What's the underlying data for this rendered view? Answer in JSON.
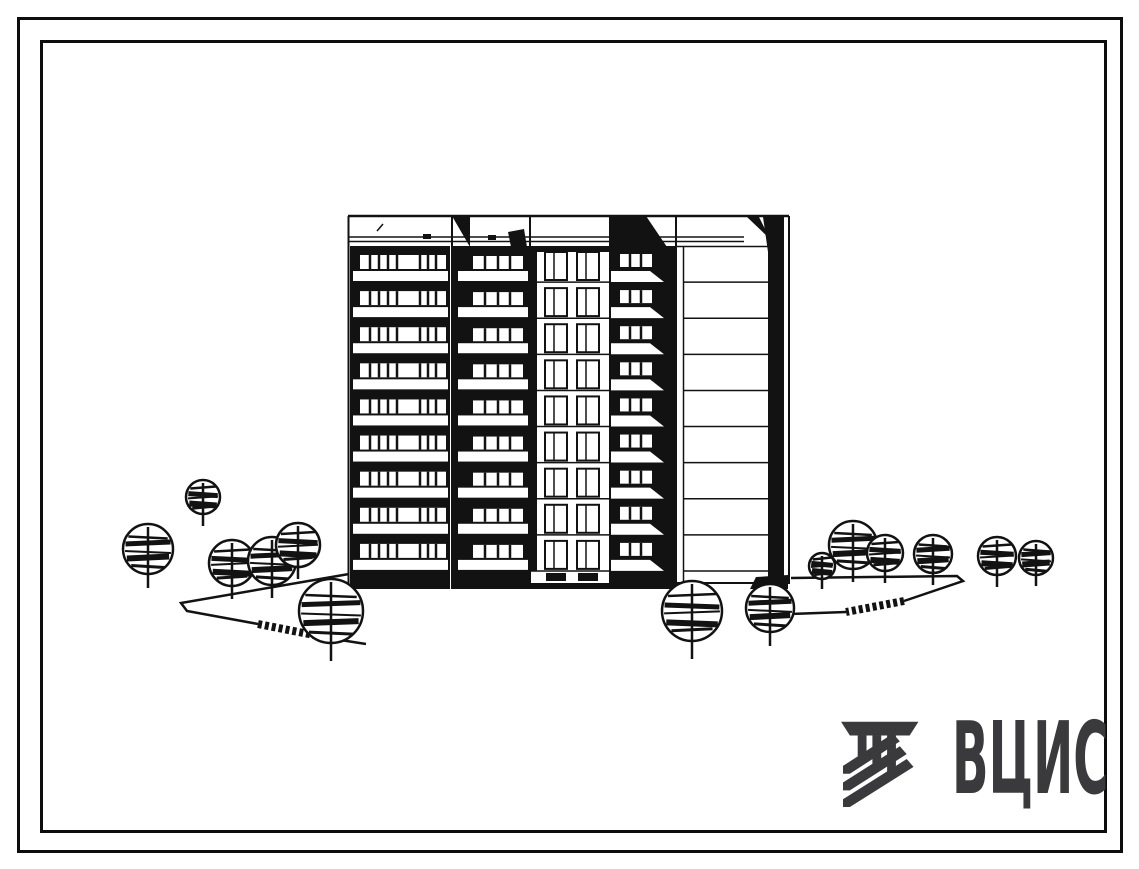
{
  "logo": {
    "text": "ВЦИС",
    "color": "#3a3a3d",
    "emblem": "vcis-column-emblem"
  },
  "drawing": {
    "type": "building-elevation",
    "ink": "#121212",
    "paper": "#ffffff",
    "floors": 9,
    "building": {
      "left": 348,
      "right": 790,
      "top": 215,
      "body_top": 246,
      "body_bottom": 571,
      "base_bottom": 589
    },
    "sections": {
      "A": {
        "name": "balcony-band-wide",
        "win": {
          "x": 360,
          "w": 86,
          "y": 9,
          "h": 14,
          "div": [
            10,
            19,
            28,
            37,
            60,
            68,
            76
          ]
        },
        "slab": {
          "x": 353,
          "w": 95,
          "y": 25,
          "h": 10
        }
      },
      "B": {
        "name": "balcony-band-narrow",
        "win": {
          "x": 473,
          "w": 50,
          "y": 10,
          "h": 13,
          "div": [
            12,
            25,
            37
          ]
        },
        "slab": {
          "x": 458,
          "w": 70,
          "y": 25,
          "h": 10
        }
      },
      "C": {
        "name": "window-bay",
        "x": 530,
        "w": 80,
        "win_xs": [
          545,
          577
        ],
        "win_w": 22,
        "win_h": 28,
        "win_y": 6,
        "mullion": 9
      },
      "D": {
        "name": "balcony-shadow-band",
        "win": {
          "x": 620,
          "w": 32,
          "y": 8,
          "h": 13,
          "div": [
            10,
            21
          ]
        },
        "slab_poly_dy": [
          25,
          36
        ],
        "slab_x": [
          610,
          650,
          664
        ]
      },
      "E": {
        "name": "end-wall",
        "line_x0": 684,
        "line_x1": 768
      }
    },
    "static_lines": [
      {
        "p": [
          [
            348,
            216
          ],
          [
            789,
            216
          ]
        ],
        "w": 2.5
      },
      {
        "p": [
          [
            349,
            237
          ],
          [
            744,
            237
          ]
        ],
        "w": 1.5
      },
      {
        "p": [
          [
            349,
            241.5
          ],
          [
            744,
            241.5
          ]
        ],
        "w": 1.5
      },
      {
        "p": [
          [
            377,
            231
          ],
          [
            383,
            224
          ]
        ],
        "w": 1.5
      },
      {
        "p": [
          [
            348.5,
            216
          ],
          [
            348.5,
            589
          ]
        ],
        "w": 2
      },
      {
        "p": [
          [
            452,
            216
          ],
          [
            452,
            589
          ]
        ],
        "w": 2
      },
      {
        "p": [
          [
            530,
            216
          ],
          [
            530,
            589
          ]
        ],
        "w": 2
      },
      {
        "p": [
          [
            610,
            216
          ],
          [
            610,
            589
          ]
        ],
        "w": 2
      },
      {
        "p": [
          [
            676,
            216
          ],
          [
            676,
            583
          ]
        ],
        "w": 2
      },
      {
        "p": [
          [
            789,
            216
          ],
          [
            789,
            583
          ]
        ],
        "w": 2
      },
      {
        "p": [
          [
            683.5,
            246
          ],
          [
            683.5,
            583
          ]
        ],
        "w": 1.5
      },
      {
        "p": [
          [
            676,
            246.5
          ],
          [
            768,
            246.5
          ]
        ],
        "w": 1.5
      },
      {
        "p": [
          [
            676,
            583
          ],
          [
            790,
            583
          ]
        ],
        "w": 2
      },
      {
        "p": [
          [
            530,
            571
          ],
          [
            610,
            571
          ]
        ],
        "w": 1.5
      },
      {
        "p": [
          [
            684,
            571
          ],
          [
            768,
            571
          ]
        ],
        "w": 1.5
      }
    ],
    "static_rects": [
      {
        "x": 350,
        "y": 246,
        "w": 100,
        "h": 343,
        "name": "section-a-body"
      },
      {
        "x": 452,
        "y": 246,
        "w": 78,
        "h": 343,
        "name": "section-b-body"
      },
      {
        "x": 610,
        "y": 246,
        "w": 66,
        "h": 343,
        "name": "section-d-body"
      },
      {
        "x": 530,
        "y": 246,
        "w": 7,
        "h": 325,
        "name": "section-c-shadow-strip"
      },
      {
        "x": 530,
        "y": 246,
        "w": 80,
        "h": 6,
        "name": "section-c-parapet-shadow"
      },
      {
        "x": 530,
        "y": 583,
        "w": 80,
        "h": 6,
        "name": "section-c-plinth"
      },
      {
        "x": 423,
        "y": 234,
        "w": 8,
        "h": 5,
        "name": "parapet-tick"
      },
      {
        "x": 488,
        "y": 235,
        "w": 8,
        "h": 5,
        "name": "parapet-tick"
      },
      {
        "x": 626,
        "y": 235,
        "w": 8,
        "h": 5,
        "name": "parapet-tick"
      },
      {
        "x": 546,
        "y": 573,
        "w": 20,
        "h": 8,
        "name": "basement-window"
      },
      {
        "x": 578,
        "y": 573,
        "w": 20,
        "h": 8,
        "name": "basement-window"
      },
      {
        "x": 768,
        "y": 250,
        "w": 16,
        "h": 333,
        "name": "end-wall-shadow-strip"
      }
    ],
    "static_polys": [
      {
        "pts": [
          [
            452,
            216
          ],
          [
            470,
            216
          ],
          [
            470,
            247
          ]
        ],
        "name": "parapet-shadow-pennant"
      },
      {
        "pts": [
          [
            508,
            232
          ],
          [
            524,
            229
          ],
          [
            527,
            247
          ],
          [
            511,
            247
          ]
        ],
        "name": "parapet-shadow-small"
      },
      {
        "pts": [
          [
            610,
            216
          ],
          [
            646,
            216
          ],
          [
            667,
            247
          ],
          [
            610,
            247
          ]
        ],
        "name": "parapet-shadow-band"
      },
      {
        "pts": [
          [
            747,
            217
          ],
          [
            759,
            217
          ],
          [
            770,
            239
          ]
        ],
        "name": "roof-shadow-tooth"
      },
      {
        "pts": [
          [
            763,
            217
          ],
          [
            784,
            217
          ],
          [
            784,
            252
          ],
          [
            768,
            252
          ]
        ],
        "name": "roof-shadow-flag"
      },
      {
        "pts": [
          [
            756,
            577
          ],
          [
            788,
            575
          ],
          [
            788,
            589
          ],
          [
            750,
            589
          ]
        ],
        "name": "shadow-strip-foot"
      }
    ],
    "paths": [
      {
        "outline": [
          [
            349,
            574
          ],
          [
            181,
            603
          ],
          [
            187,
            611
          ],
          [
            258,
            624
          ]
        ],
        "hatch": [
          [
            258,
            624
          ],
          [
            334,
            639
          ]
        ],
        "tail": [
          [
            334,
            639
          ],
          [
            366,
            644
          ]
        ]
      },
      {
        "outline": [
          [
            791,
            578
          ],
          [
            957,
            576
          ],
          [
            963,
            581
          ],
          [
            904,
            601
          ]
        ],
        "hatch": [
          [
            904,
            601
          ],
          [
            846,
            612
          ]
        ],
        "tail": [
          [
            846,
            612
          ],
          [
            790,
            614
          ]
        ]
      }
    ],
    "trees": [
      {
        "x": 203,
        "y": 497,
        "r": 17,
        "t": 12
      },
      {
        "x": 148,
        "y": 549,
        "r": 25,
        "t": 14
      },
      {
        "x": 232,
        "y": 563,
        "r": 23,
        "t": 13
      },
      {
        "x": 272,
        "y": 561,
        "r": 24,
        "t": 13
      },
      {
        "x": 298,
        "y": 545,
        "r": 22,
        "t": 12
      },
      {
        "x": 331,
        "y": 611,
        "r": 32,
        "t": 18
      },
      {
        "x": 692,
        "y": 611,
        "r": 30,
        "t": 18
      },
      {
        "x": 770,
        "y": 608,
        "r": 24,
        "t": 14
      },
      {
        "x": 822,
        "y": 566,
        "r": 13,
        "t": 10
      },
      {
        "x": 853,
        "y": 545,
        "r": 24,
        "t": 13
      },
      {
        "x": 885,
        "y": 553,
        "r": 18,
        "t": 12
      },
      {
        "x": 933,
        "y": 554,
        "r": 19,
        "t": 12
      },
      {
        "x": 997,
        "y": 556,
        "r": 19,
        "t": 12
      },
      {
        "x": 1036,
        "y": 558,
        "r": 17,
        "t": 11
      }
    ]
  }
}
